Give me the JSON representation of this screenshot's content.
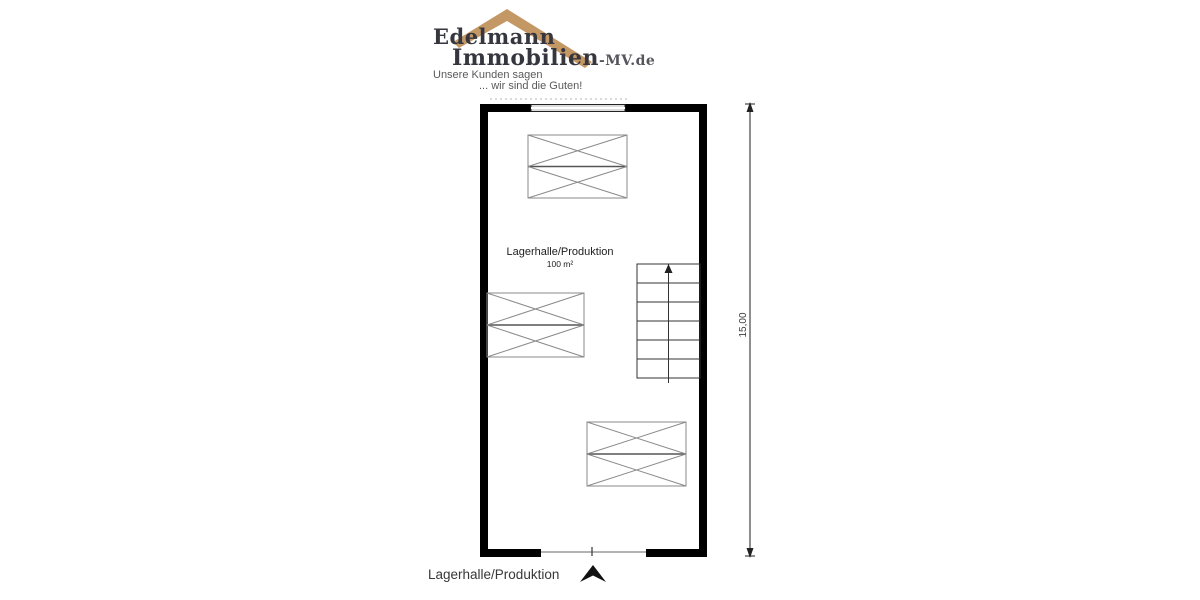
{
  "page": {
    "background": "#ffffff"
  },
  "logo": {
    "brand_line1": "Edelmann",
    "brand_line2": "Immobilien",
    "brand_suffix": "-MV.de",
    "tagline_line1": "Unsere Kunden sagen",
    "tagline_line2": "... wir sind die Guten!",
    "roof_color": "#c49865",
    "brand_text_color": "#36363e",
    "tagline_text_color": "#595959"
  },
  "floor_plan": {
    "room_label": "Lagerhalle/Produktion",
    "room_area": "100 m²",
    "wall_color": "#000000",
    "furniture_line_color": "#8a8a8a",
    "stair_line_color": "#333333",
    "features": [
      "window in top wall",
      "wide gate opening in bottom wall",
      "staircase along right wall with up-direction arrow",
      "three crossed storage-rack rectangles"
    ]
  },
  "dimension": {
    "height_label": "15,00",
    "line_color": "#444444"
  },
  "footer": {
    "plan_label": "Lagerhalle/Produktion"
  }
}
